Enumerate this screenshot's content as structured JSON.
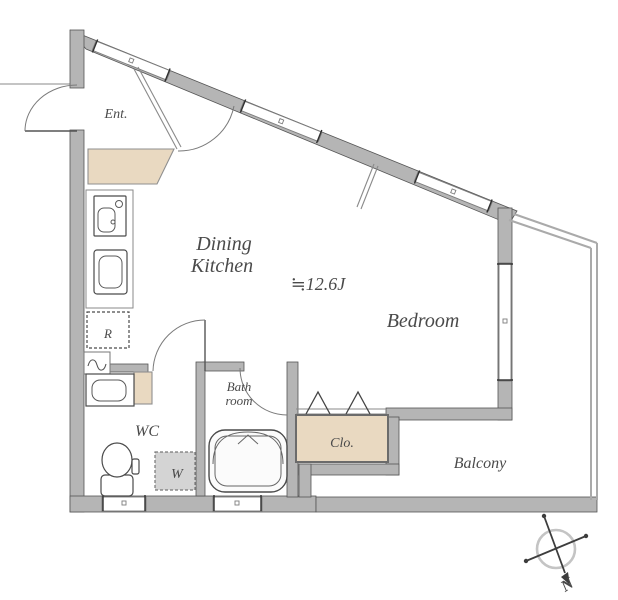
{
  "plan": {
    "type": "apartment-floor-plan",
    "rooms": {
      "entrance": "Ent.",
      "dining_kitchen_line1": "Dining",
      "dining_kitchen_line2": "Kitchen",
      "floor_area": "≒12.6J",
      "bedroom": "Bedroom",
      "wc": "WC",
      "bathroom_line1": "Bath",
      "bathroom_line2": "room",
      "closet": "Clo.",
      "balcony": "Balcony"
    },
    "fixtures": {
      "refrigerator_label": "R",
      "washing_machine_label": "W"
    },
    "compass": {
      "north_label": "N"
    },
    "colors": {
      "wall": "#b5b5b5",
      "floor_accent": "#e9d9c1",
      "washer_fill": "#d4d4d4",
      "text": "#4a4a4a"
    }
  }
}
